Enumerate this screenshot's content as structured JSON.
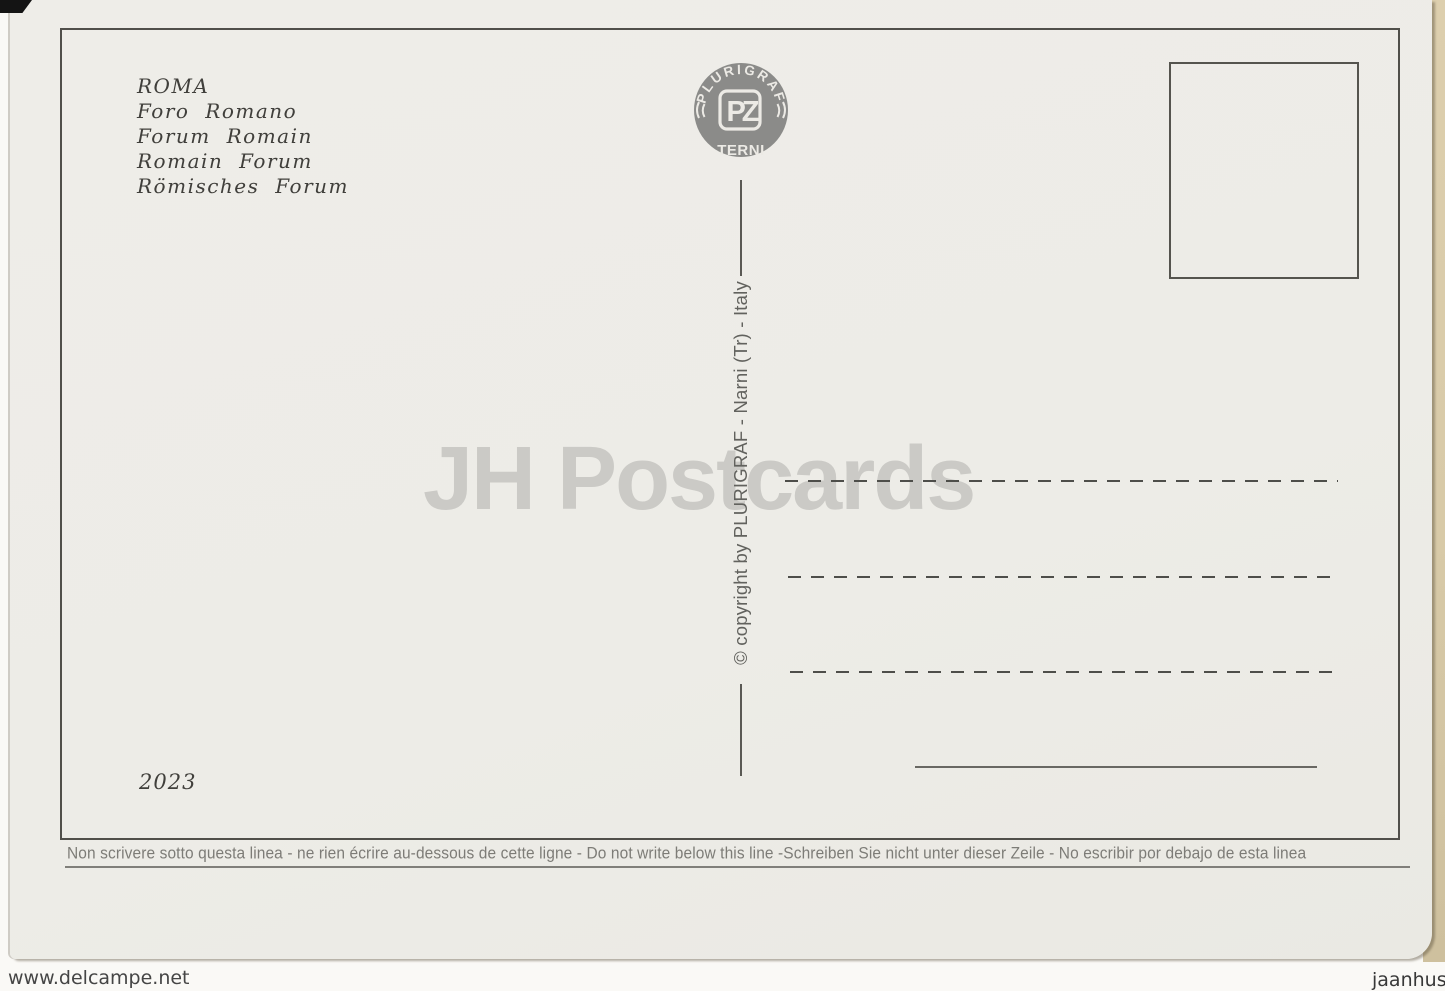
{
  "postcard": {
    "title_lines": [
      "ROMA",
      "Foro Romano",
      "Forum Romain",
      "Romain Forum",
      "Römisches Forum"
    ],
    "publisher": {
      "arc_text": "PLURIGRAF",
      "monogram": "PZ",
      "city": "TERNI"
    },
    "copyright_line": "© copyright by PLURIGRAF - Narni (Tr) - Italy",
    "catalog_number": "2023",
    "instruction_line": "Non scrivere sotto questa linea - ne rien écrire au-dessous de cette ligne - Do not write below this line -Schreiben Sie nicht unter dieser Zeile - No escribir por debajo de esta linea"
  },
  "watermarks": {
    "center": "JH Postcards",
    "site": "www.delcampe.net",
    "seller": "jaanhus"
  },
  "colors": {
    "card_background": "#edece7",
    "frame_line": "#504f4a",
    "logo_gray": "#8b8b89",
    "dash_line": "#4e4e4a",
    "center_watermark": "#cbcac6",
    "album_strip": "#d8caa8"
  }
}
